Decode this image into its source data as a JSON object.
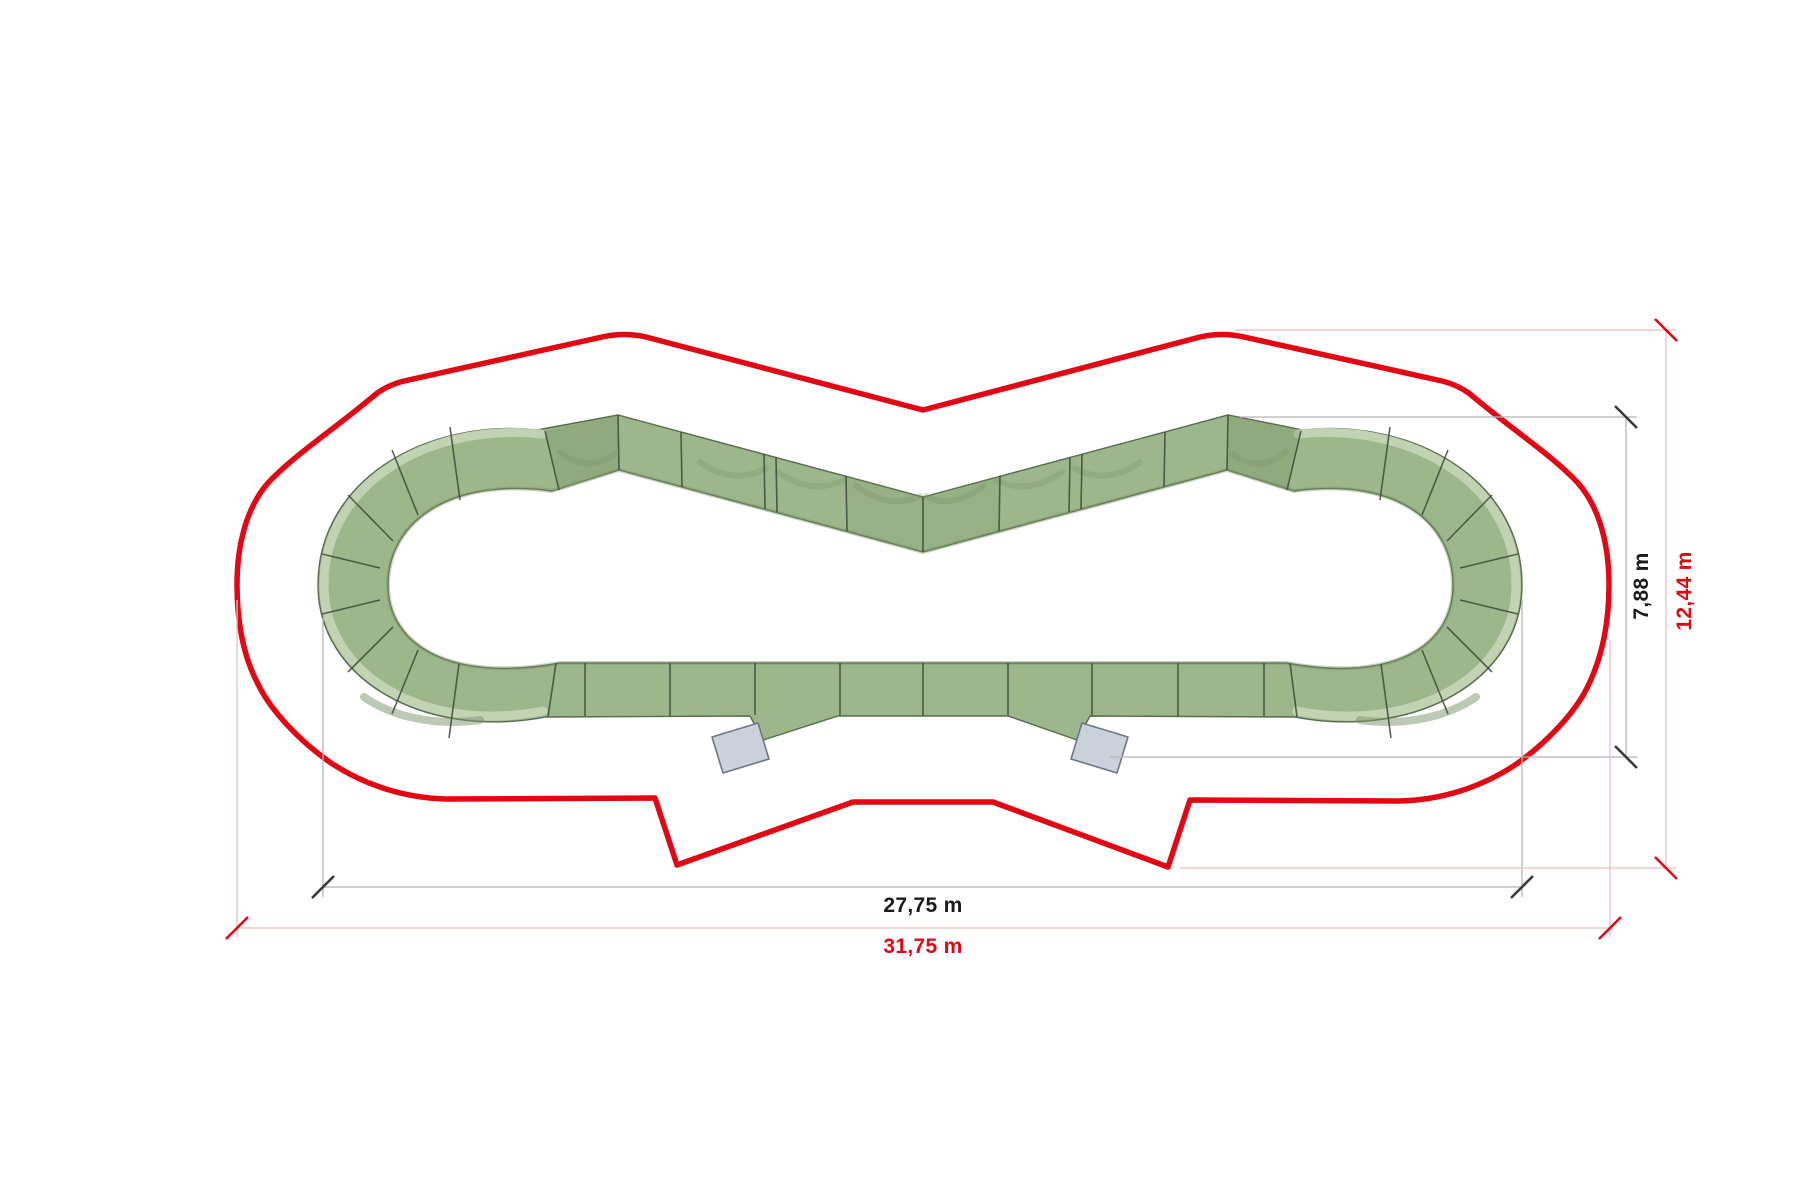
{
  "diagram": {
    "name": "modular-pump-track-top-view-plan",
    "dimension_labels": {
      "track_width": "27,75 m",
      "zone_width": "31,75 m",
      "track_depth": "7,88 m",
      "zone_depth": "12,44 m"
    },
    "colors": {
      "background": "#ffffff",
      "track_fill": "#9cb78c",
      "track_edge": "#5a6b4e",
      "seam": "#3e4937",
      "berm_highlight": "#c7d6b8",
      "track_shadow": "#7b9369",
      "safety_outline": "#e30613",
      "dim_gray": "#b5b5b5",
      "dim_black": "#3a3a3a",
      "text_black": "#1a1a1a",
      "dim_red_light": "#f0bcbc",
      "dim_red": "#e30613",
      "ramp_fill": "#ccd2da",
      "ramp_edge": "#6e7682"
    }
  }
}
